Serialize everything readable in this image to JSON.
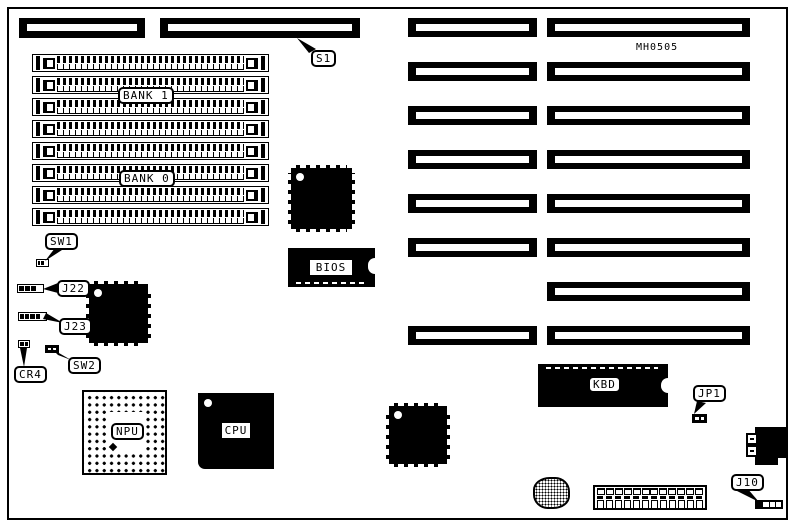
{
  "diagram": {
    "board_id": "MH0505",
    "memory": {
      "bank1_label": "BANK 1",
      "bank0_label": "BANK 0",
      "socket_count": 8
    },
    "chips": {
      "bios_label": "BIOS",
      "cpu_label": "CPU",
      "npu_label": "NPU",
      "kbd_label": "KBD"
    },
    "callouts": {
      "s1": "S1",
      "sw1": "SW1",
      "j22": "J22",
      "j23": "J23",
      "cr4": "CR4",
      "sw2": "SW2",
      "jp1": "JP1",
      "j10": "J10"
    },
    "expansion_slots": {
      "left_column_count": 7,
      "right_column_count": 8
    }
  }
}
